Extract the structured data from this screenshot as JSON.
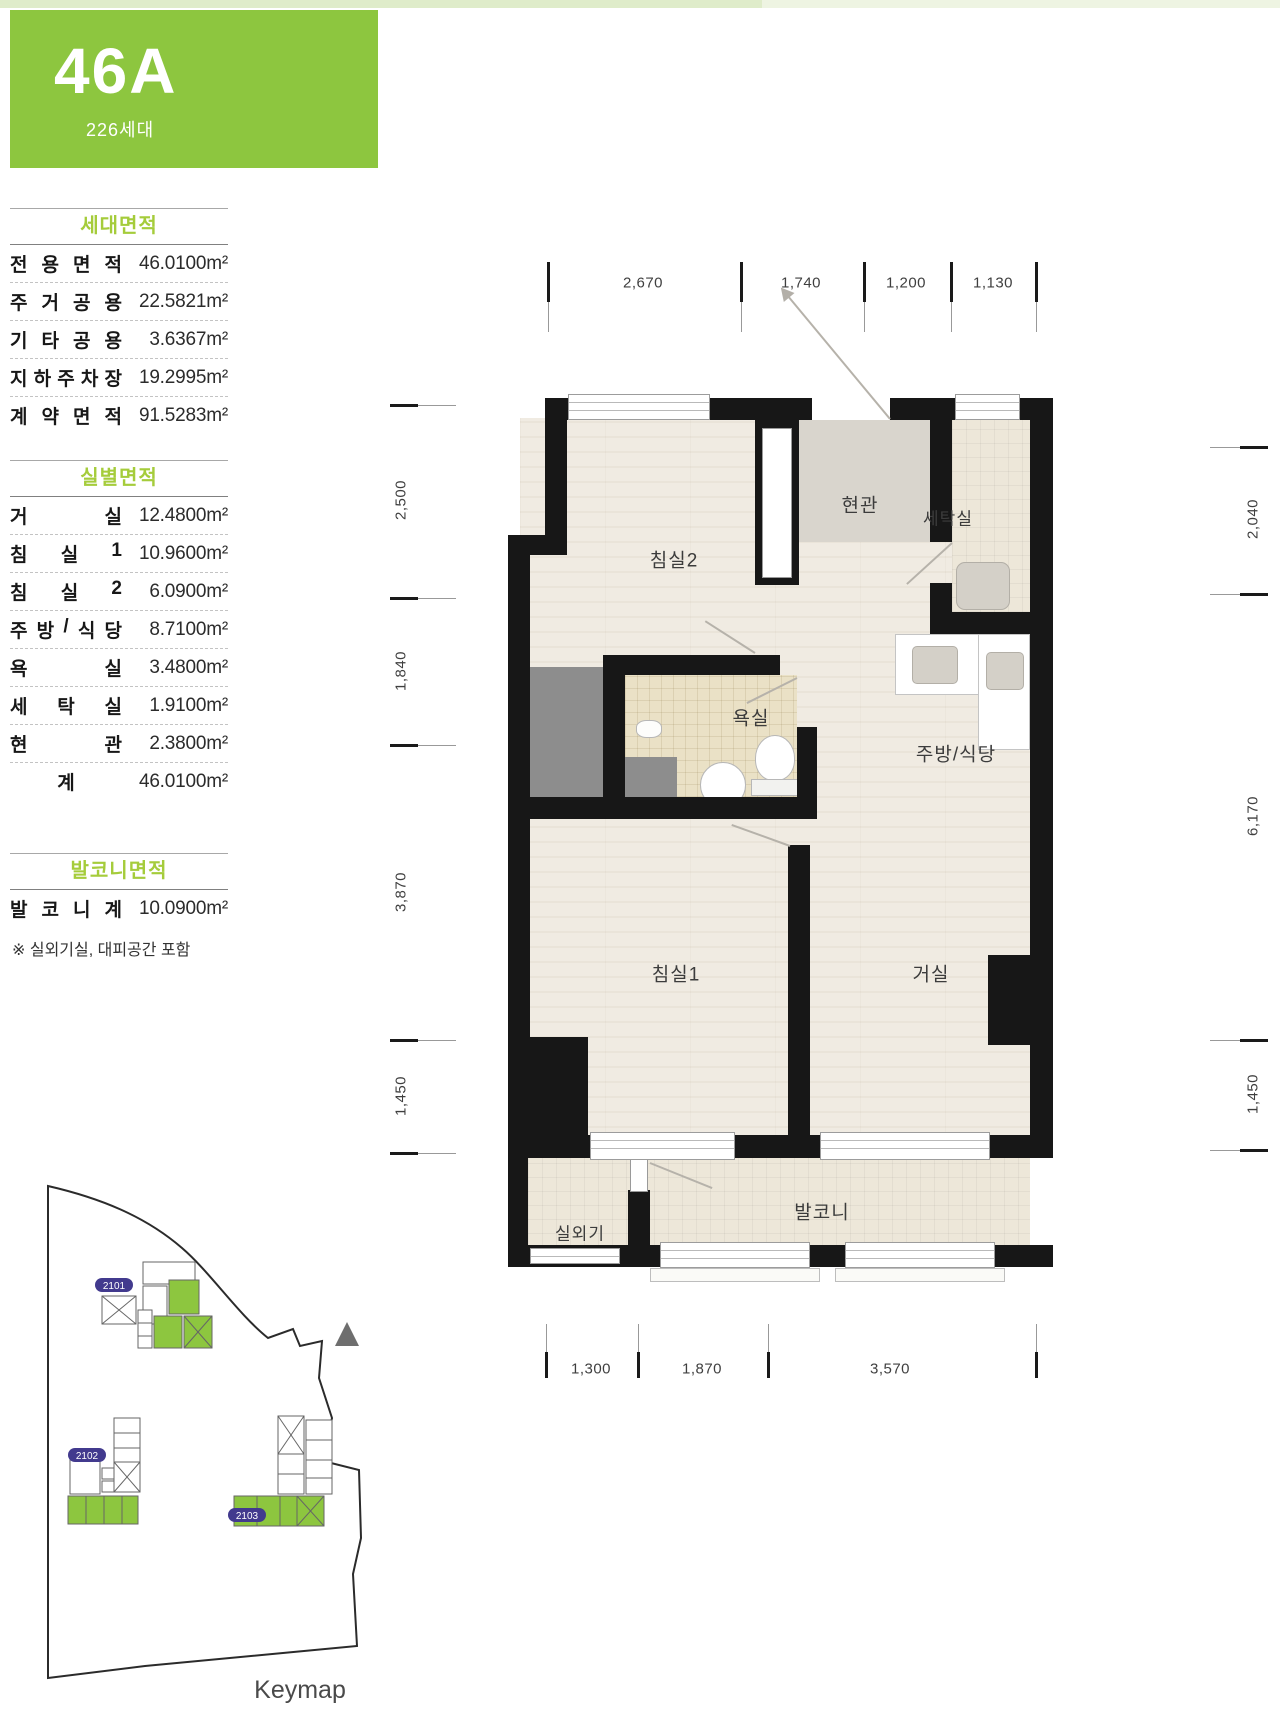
{
  "header": {
    "unit_code": "46A",
    "units_count": "226세대",
    "accent": "#8dc63f"
  },
  "panel": {
    "tables": [
      {
        "title": "세대면적",
        "rows": [
          {
            "label": "전용면적",
            "value": "46.0100m²"
          },
          {
            "label": "주거공용",
            "value": "22.5821m²"
          },
          {
            "label": "기타공용",
            "value": "3.6367m²"
          },
          {
            "label": "지하주차장",
            "value": "19.2995m²"
          },
          {
            "label": "계약면적",
            "value": "91.5283m²"
          }
        ]
      },
      {
        "title": "실별면적",
        "rows": [
          {
            "label": "거실",
            "value": "12.4800m²"
          },
          {
            "label": "침실1",
            "value": "10.9600m²"
          },
          {
            "label": "침실2",
            "value": "6.0900m²"
          },
          {
            "label": "주방/식당",
            "value": "8.7100m²"
          },
          {
            "label": "욕실",
            "value": "3.4800m²"
          },
          {
            "label": "세탁실",
            "value": "1.9100m²"
          },
          {
            "label": "현관",
            "value": "2.3800m²"
          },
          {
            "label": "계",
            "value": "46.0100m²"
          }
        ]
      },
      {
        "title": "발코니면적",
        "rows": [
          {
            "label": "발코니계",
            "value": "10.0900m²"
          }
        ]
      }
    ],
    "note": "※ 실외기실, 대피공간 포함"
  },
  "floorplan": {
    "rooms": {
      "bedroom2": "침실2",
      "entrance": "현관",
      "laundry": "세탁실",
      "bathroom": "욕실",
      "kitchen": "주방/식당",
      "bedroom1": "침실1",
      "living": "거실",
      "ac_unit": "실외기",
      "balcony": "발코니"
    },
    "dims": {
      "top": [
        "2,670",
        "1,740",
        "1,200",
        "1,130"
      ],
      "left": [
        "2,500",
        "1,840",
        "3,870",
        "1,450"
      ],
      "right": [
        "2,040",
        "6,170",
        "1,450"
      ],
      "bottom": [
        "1,300",
        "1,870",
        "3,570"
      ]
    }
  },
  "keymap": {
    "label": "Keymap",
    "badge_color": "#423a8e",
    "highlight_color": "#8dc63f",
    "buildings": [
      {
        "id": "2101"
      },
      {
        "id": "2102"
      },
      {
        "id": "2103"
      }
    ]
  }
}
